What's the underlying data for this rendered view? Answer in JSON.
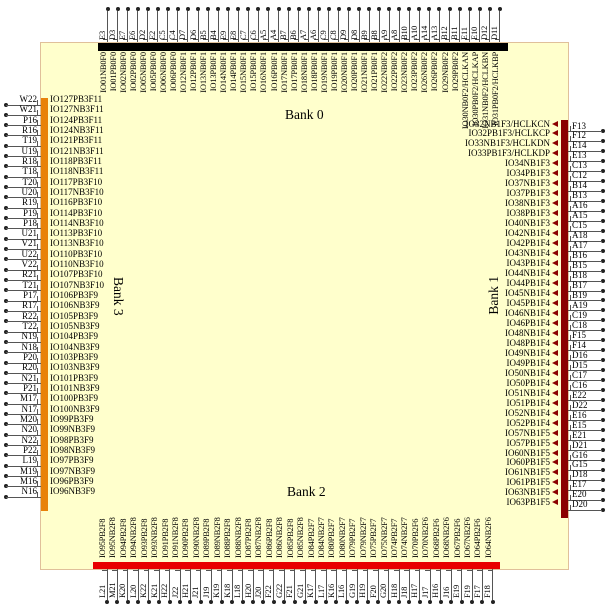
{
  "diagram": {
    "chip": {
      "fill": "#ffffcc",
      "border": "#e0c09a"
    },
    "banks": {
      "top": {
        "label": "Bank 0",
        "color": "#000000"
      },
      "right": {
        "label": "Bank 1",
        "color": "#8b0000"
      },
      "bottom": {
        "label": "Bank 2",
        "color": "#e80000"
      },
      "left": {
        "label": "Bank 3",
        "color": "#e8820a"
      }
    },
    "sides": {
      "top": {
        "pins": [
          {
            "ball": "E3",
            "io": "IO01NB0F0"
          },
          {
            "ball": "D3",
            "io": "IO01PB0F0"
          },
          {
            "ball": "E7",
            "io": "IO02NB0F0"
          },
          {
            "ball": "E6",
            "io": "IO02PB0F0"
          },
          {
            "ball": "D2",
            "io": "IO05NB0F0"
          },
          {
            "ball": "E2",
            "io": "IO05PB0F0"
          },
          {
            "ball": "C5",
            "io": "IO06NB0F0"
          },
          {
            "ball": "C4",
            "io": "IO06PB0F0"
          },
          {
            "ball": "D7",
            "io": "IO12NB0F1"
          },
          {
            "ball": "D6",
            "io": "IO12PB0F1"
          },
          {
            "ball": "B5",
            "io": "IO13NB0F1"
          },
          {
            "ball": "B4",
            "io": "IO13PB0F1"
          },
          {
            "ball": "E9",
            "io": "IO14NB0F1"
          },
          {
            "ball": "E8",
            "io": "IO14PB0F1"
          },
          {
            "ball": "C7",
            "io": "IO15NB0F1"
          },
          {
            "ball": "C6",
            "io": "IO15PB0F1"
          },
          {
            "ball": "A5",
            "io": "IO16NB0F1"
          },
          {
            "ball": "A4",
            "io": "IO16PB0F1"
          },
          {
            "ball": "B7",
            "io": "IO17NB0F1"
          },
          {
            "ball": "B6",
            "io": "IO17PB0F1"
          },
          {
            "ball": "A7",
            "io": "IO18NB0F1"
          },
          {
            "ball": "A6",
            "io": "IO18PB0F1"
          },
          {
            "ball": "C9",
            "io": "IO19NB0F1"
          },
          {
            "ball": "C8",
            "io": "IO19PB0F1"
          },
          {
            "ball": "D9",
            "io": "IO20NB0F1"
          },
          {
            "ball": "D8",
            "io": "IO20PB0F1"
          },
          {
            "ball": "B9",
            "io": "IO21NB0F1"
          },
          {
            "ball": "B8",
            "io": "IO21PB0F1"
          },
          {
            "ball": "A9",
            "io": "IO22NB0F2"
          },
          {
            "ball": "A8",
            "io": "IO22PB0F2"
          },
          {
            "ball": "B10",
            "io": "IO23NB0F2"
          },
          {
            "ball": "A10",
            "io": "IO23PB0F2"
          },
          {
            "ball": "A14",
            "io": "IO26NB0F2"
          },
          {
            "ball": "A13",
            "io": "IO26PB0F2"
          },
          {
            "ball": "B12",
            "io": "IO29NB0F2"
          },
          {
            "ball": "B11",
            "io": "IO29PB0F2"
          },
          {
            "ball": "E11",
            "io": "IO30NB0F2/HCLKAN"
          },
          {
            "ball": "E10",
            "io": "IO30PB0F2/HCLKAP"
          },
          {
            "ball": "D12",
            "io": "IO31NB0F2/HCLKBN"
          },
          {
            "ball": "D11",
            "io": "IO31PB0F2/HCLKBP"
          }
        ]
      },
      "left": {
        "pins": [
          {
            "ball": "W22",
            "io": "IO127PB3F11"
          },
          {
            "ball": "W21",
            "io": "IO127NB3F11"
          },
          {
            "ball": "P16",
            "io": "IO124PB3F11"
          },
          {
            "ball": "R16",
            "io": "IO124NB3F11"
          },
          {
            "ball": "T19",
            "io": "IO121PB3F11"
          },
          {
            "ball": "U19",
            "io": "IO121NB3F11"
          },
          {
            "ball": "R18",
            "io": "IO118PB3F11"
          },
          {
            "ball": "T18",
            "io": "IO118NB3F11"
          },
          {
            "ball": "T20",
            "io": "IO117PB3F10"
          },
          {
            "ball": "U20",
            "io": "IO117NB3F10"
          },
          {
            "ball": "R19",
            "io": "IO116PB3F10"
          },
          {
            "ball": "P19",
            "io": "IO114PB3F10"
          },
          {
            "ball": "P18",
            "io": "IO114NB3F10"
          },
          {
            "ball": "U21",
            "io": "IO113PB3F10"
          },
          {
            "ball": "V21",
            "io": "IO113NB3F10"
          },
          {
            "ball": "U22",
            "io": "IO110PB3F10"
          },
          {
            "ball": "V22",
            "io": "IO110NB3F10"
          },
          {
            "ball": "R21",
            "io": "IO107PB3F10"
          },
          {
            "ball": "T21",
            "io": "IO107NB3F10"
          },
          {
            "ball": "P17",
            "io": "IO106PB3F9"
          },
          {
            "ball": "R17",
            "io": "IO106NB3F9"
          },
          {
            "ball": "R22",
            "io": "IO105PB3F9"
          },
          {
            "ball": "T22",
            "io": "IO105NB3F9"
          },
          {
            "ball": "N19",
            "io": "IO104PB3F9"
          },
          {
            "ball": "N18",
            "io": "IO104NB3F9"
          },
          {
            "ball": "P20",
            "io": "IO103PB3F9"
          },
          {
            "ball": "R20",
            "io": "IO103NB3F9"
          },
          {
            "ball": "N21",
            "io": "IO101PB3F9"
          },
          {
            "ball": "P21",
            "io": "IO101NB3F9"
          },
          {
            "ball": "M17",
            "io": "IO100PB3F9"
          },
          {
            "ball": "N17",
            "io": "IO100NB3F9"
          },
          {
            "ball": "M20",
            "io": "IO99PB3F9"
          },
          {
            "ball": "N20",
            "io": "IO99NB3F9"
          },
          {
            "ball": "N22",
            "io": "IO98PB3F9"
          },
          {
            "ball": "P22",
            "io": "IO98NB3F9"
          },
          {
            "ball": "L19",
            "io": "IO97PB3F9"
          },
          {
            "ball": "M19",
            "io": "IO97NB3F9"
          },
          {
            "ball": "M16",
            "io": "IO96PB3F9"
          },
          {
            "ball": "N16",
            "io": "IO96NB3F9"
          }
        ]
      },
      "right": {
        "pins": [
          {
            "ball": "F13",
            "io": "IO32NB1F3/HCLKCN"
          },
          {
            "ball": "F12",
            "io": "IO32PB1F3/HCLKCP"
          },
          {
            "ball": "E14",
            "io": "IO33NB1F3/HCLKDN"
          },
          {
            "ball": "E13",
            "io": "IO33PB1F3/HCLKDP"
          },
          {
            "ball": "C13",
            "io": "IO34NB1F3"
          },
          {
            "ball": "C12",
            "io": "IO34PB1F3"
          },
          {
            "ball": "B14",
            "io": "IO37NB1F3"
          },
          {
            "ball": "B13",
            "io": "IO37PB1F3"
          },
          {
            "ball": "A16",
            "io": "IO38NB1F3"
          },
          {
            "ball": "A15",
            "io": "IO38PB1F3"
          },
          {
            "ball": "C15",
            "io": "IO40NB1F3"
          },
          {
            "ball": "A18",
            "io": "IO42NB1F4"
          },
          {
            "ball": "A17",
            "io": "IO42PB1F4"
          },
          {
            "ball": "B16",
            "io": "IO43NB1F4"
          },
          {
            "ball": "B15",
            "io": "IO43PB1F4"
          },
          {
            "ball": "B18",
            "io": "IO44NB1F4"
          },
          {
            "ball": "B17",
            "io": "IO44PB1F4"
          },
          {
            "ball": "B19",
            "io": "IO45NB1F4"
          },
          {
            "ball": "A19",
            "io": "IO45PB1F4"
          },
          {
            "ball": "C19",
            "io": "IO46NB1F4"
          },
          {
            "ball": "C18",
            "io": "IO46PB1F4"
          },
          {
            "ball": "F15",
            "io": "IO48NB1F4"
          },
          {
            "ball": "F14",
            "io": "IO48PB1F4"
          },
          {
            "ball": "D16",
            "io": "IO49NB1F4"
          },
          {
            "ball": "D15",
            "io": "IO49PB1F4"
          },
          {
            "ball": "C17",
            "io": "IO50NB1F4"
          },
          {
            "ball": "C16",
            "io": "IO50PB1F4"
          },
          {
            "ball": "E22",
            "io": "IO51NB1F4"
          },
          {
            "ball": "D22",
            "io": "IO51PB1F4"
          },
          {
            "ball": "E16",
            "io": "IO52NB1F4"
          },
          {
            "ball": "E15",
            "io": "IO52PB1F4"
          },
          {
            "ball": "E21",
            "io": "IO57NB1F5"
          },
          {
            "ball": "D21",
            "io": "IO57PB1F5"
          },
          {
            "ball": "G16",
            "io": "IO60NB1F5"
          },
          {
            "ball": "G15",
            "io": "IO60PB1F5"
          },
          {
            "ball": "D18",
            "io": "IO61NB1F5"
          },
          {
            "ball": "E17",
            "io": "IO61PB1F5"
          },
          {
            "ball": "E20",
            "io": "IO63NB1F5"
          },
          {
            "ball": "D20",
            "io": "IO63PB1F5"
          }
        ]
      },
      "bottom": {
        "pins": [
          {
            "ball": "L21",
            "io": "IO95PB2F8"
          },
          {
            "ball": "M21",
            "io": "IO95NB2F8"
          },
          {
            "ball": "K20",
            "io": "IO94PB2F8"
          },
          {
            "ball": "L20",
            "io": "IO94NB2F8"
          },
          {
            "ball": "K22",
            "io": "IO93PB2F8"
          },
          {
            "ball": "K21",
            "io": "IO93NB2F8"
          },
          {
            "ball": "H22",
            "io": "IO91PB2F8"
          },
          {
            "ball": "J22",
            "io": "IO91NB2F8"
          },
          {
            "ball": "H21",
            "io": "IO90PB2F8"
          },
          {
            "ball": "J21",
            "io": "IO90NB2F8"
          },
          {
            "ball": "J19",
            "io": "IO89PB2F8"
          },
          {
            "ball": "K19",
            "io": "IO89NB2F8"
          },
          {
            "ball": "K18",
            "io": "IO88PB2F8"
          },
          {
            "ball": "L18",
            "io": "IO88NB2F8"
          },
          {
            "ball": "H20",
            "io": "IO87PB2F8"
          },
          {
            "ball": "J20",
            "io": "IO87NB2F8"
          },
          {
            "ball": "F22",
            "io": "IO86PB2F8"
          },
          {
            "ball": "G22",
            "io": "IO86NB2F8"
          },
          {
            "ball": "F21",
            "io": "IO85PB2F8"
          },
          {
            "ball": "G21",
            "io": "IO85NB2F8"
          },
          {
            "ball": "K17",
            "io": "IO84PB2F7"
          },
          {
            "ball": "L17",
            "io": "IO84NB2F7"
          },
          {
            "ball": "K16",
            "io": "IO80PB2F7"
          },
          {
            "ball": "L16",
            "io": "IO80NB2F7"
          },
          {
            "ball": "G19",
            "io": "IO79PB2F7"
          },
          {
            "ball": "H19",
            "io": "IO79NB2F7"
          },
          {
            "ball": "F20",
            "io": "IO75PB2F7"
          },
          {
            "ball": "G20",
            "io": "IO75NB2F7"
          },
          {
            "ball": "H18",
            "io": "IO74PB2F7"
          },
          {
            "ball": "J18",
            "io": "IO74NB2F7"
          },
          {
            "ball": "H17",
            "io": "IO70PB2F6"
          },
          {
            "ball": "J17",
            "io": "IO70NB2F6"
          },
          {
            "ball": "H16",
            "io": "IO68PB2F6"
          },
          {
            "ball": "J16",
            "io": "IO68NB2F6"
          },
          {
            "ball": "E19",
            "io": "IO67PB2F6"
          },
          {
            "ball": "F19",
            "io": "IO67NB2F6"
          },
          {
            "ball": "F17",
            "io": "IO64PB2F6"
          },
          {
            "ball": "F18",
            "io": "IO64NB2F6"
          }
        ]
      }
    }
  }
}
